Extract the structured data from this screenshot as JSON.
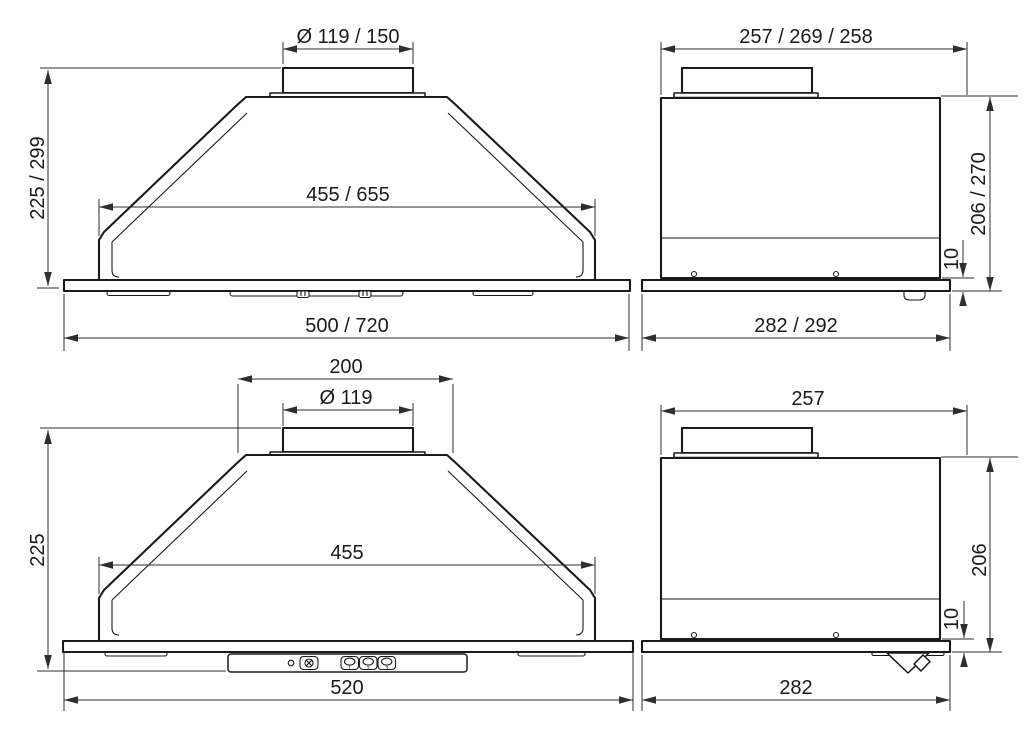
{
  "colors": {
    "background": "#ffffff",
    "object_line": "#1a1a1a",
    "dimension_line": "#2e2e2e",
    "text": "#1a1a1a"
  },
  "views": {
    "front_large": {
      "dims": {
        "duct_diameter": "Ø 119 / 150",
        "height": "225 / 299",
        "body_width": "455 / 655",
        "overall_width": "500 / 720"
      }
    },
    "side_large": {
      "dims": {
        "top_depth": "257 / 269 / 258",
        "height": "206 / 270",
        "plate_offset": "10",
        "overall_depth": "282 / 292"
      }
    },
    "front_small": {
      "dims": {
        "top_width": "200",
        "duct_diameter": "Ø 119",
        "height": "225",
        "body_width": "455",
        "overall_width": "520"
      }
    },
    "side_small": {
      "dims": {
        "top_depth": "257",
        "height": "206",
        "plate_offset": "10",
        "overall_depth": "282"
      }
    }
  },
  "control_panel": {
    "speed_buttons": [
      "1",
      "2",
      "3"
    ]
  }
}
